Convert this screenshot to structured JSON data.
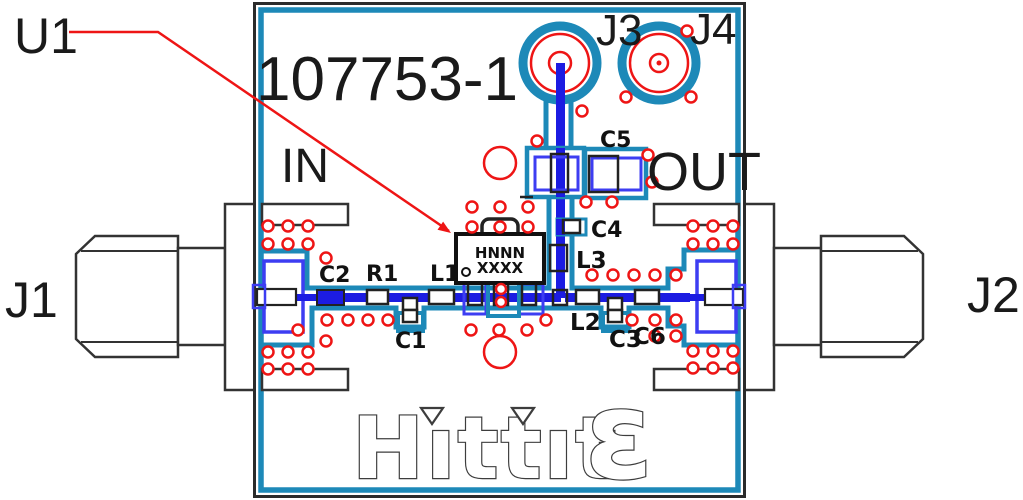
{
  "board": {
    "part_number": "107753-1",
    "silkscreen": {
      "in": "IN",
      "out": "OUT"
    }
  },
  "designators": {
    "u1": "U1",
    "j1": "J1",
    "j2": "J2",
    "j3": "J3",
    "j4": "J4"
  },
  "components": {
    "c1": "C1",
    "c2": "C2",
    "c3": "C3",
    "c4": "C4",
    "c5": "C5",
    "c6": "C6",
    "r1": "R1",
    "l1": "L1",
    "l2": "L2",
    "l3": "L3"
  },
  "ic": {
    "line1": "HNNN",
    "line2": "XXXX"
  },
  "logo": {
    "brand": "Hittite",
    "display_word": "Hıttıt",
    "display_epsilon": "ε"
  },
  "colors": {
    "copper": "#1d89b8",
    "trace": "#1c1ce2",
    "pad": "#3d3df2",
    "via": "#ee1515",
    "silkscreen": "#1a1a1a",
    "outline": "#3d3d3d",
    "leader": "#ee1515"
  }
}
